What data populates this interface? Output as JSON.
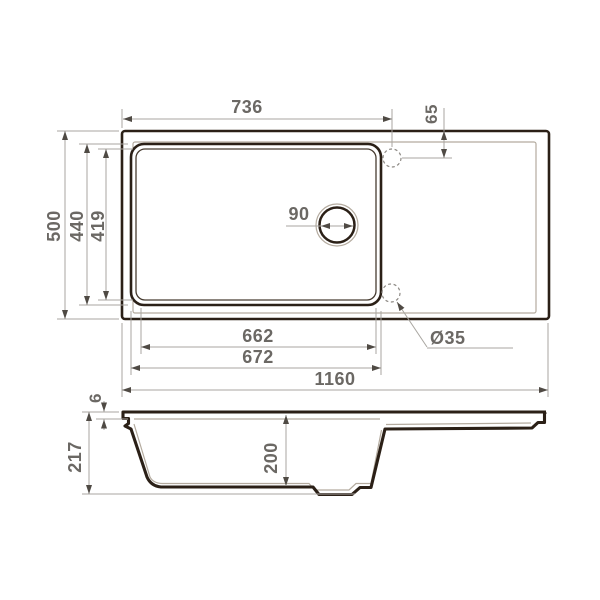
{
  "drawing": {
    "kind": "sink-dimension-drawing",
    "colors": {
      "outline": "#2b2017",
      "thin_line": "#b4ab9f",
      "dim_line": "#a8a5a0",
      "arrow": "#4f4a44",
      "dim_text": "#6b6864",
      "background": "#ffffff"
    },
    "top_view": {
      "dims": {
        "faucet_from_left": "736",
        "faucet_from_edge": "65",
        "total_depth": "500",
        "bowl_outer_depth": "440",
        "bowl_inner_depth": "419",
        "drain_diameter": "90",
        "bowl_inner_width": "662",
        "bowl_outer_width": "672",
        "total_width": "1160",
        "faucet_hole_diameter": "Ø35"
      }
    },
    "side_view": {
      "dims": {
        "rim_thickness": "6",
        "total_height": "217",
        "bowl_depth": "200"
      }
    }
  }
}
